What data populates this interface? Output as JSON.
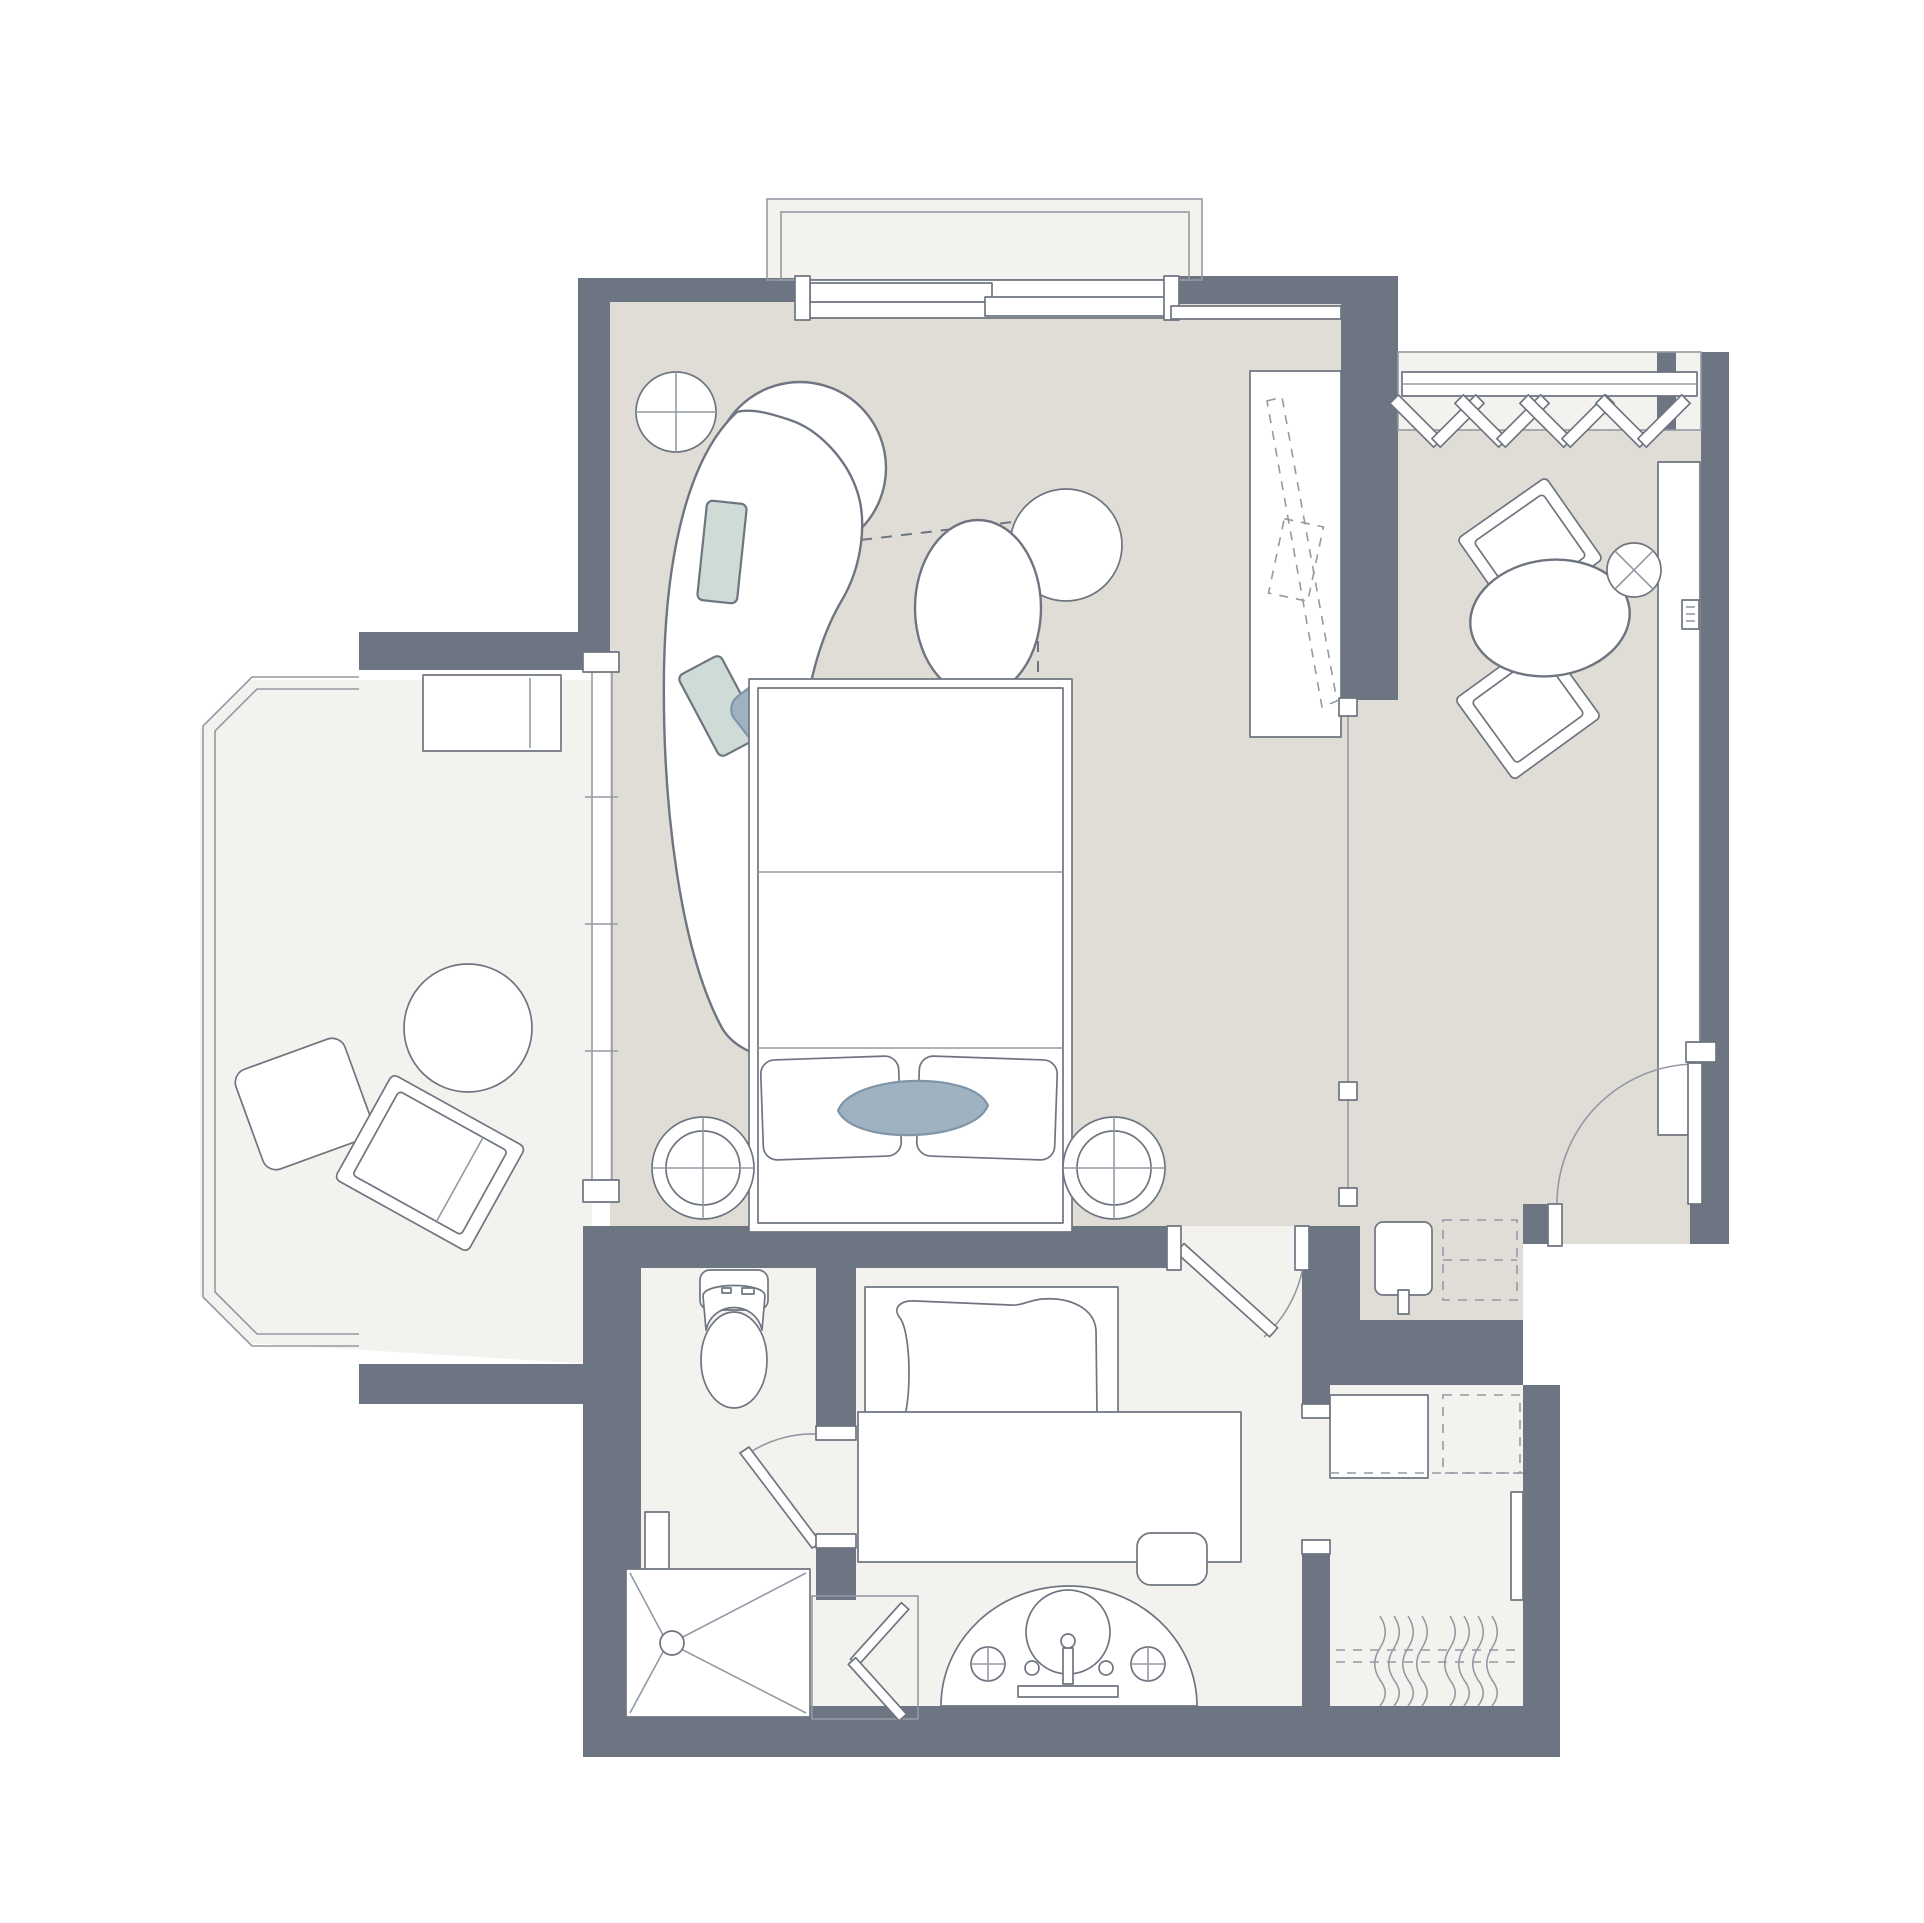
{
  "page": {
    "background": "#ffffff",
    "kind": "hotel-guestroom-floor-plan"
  },
  "colors": {
    "wall": "#6d7482",
    "floor_main": "#e0ddd6",
    "floor_light": "#f3f2ee",
    "line": "#6f7580",
    "line_light": "#949aa4",
    "cushion": "#cfdbd7",
    "pillow": "#9fb2c1",
    "pillow_edge": "#7f95a8"
  },
  "plan": {
    "rooms": [
      "living-bedroom",
      "dressing-entry-area",
      "wardrobe-niche",
      "balcony",
      "juliet-balcony",
      "wc-shower-room",
      "bath-corridor",
      "walk-in-closet"
    ],
    "furniture": [
      "curved-sofa",
      "sofa-cushions",
      "accent-pillow",
      "side-table",
      "coffee-table",
      "ottoman",
      "tv-cabinet",
      "tv-dashed-outline",
      "king-bed",
      "bed-pillows",
      "nightstand-left",
      "nightstand-right",
      "balcony-lounger",
      "balcony-chairs",
      "balcony-table",
      "desk-console",
      "desk-chairs",
      "oval-table",
      "stool-side-table",
      "closet-hangers",
      "minibar",
      "coffee-tray",
      "entry-door",
      "bath-door",
      "wc-door",
      "toilet",
      "bathtub",
      "shower",
      "shower-folding-door",
      "vanity-basin",
      "vanity-counter",
      "vanity-stool",
      "luggage-rack",
      "hanging-clothes",
      "mirror"
    ]
  }
}
